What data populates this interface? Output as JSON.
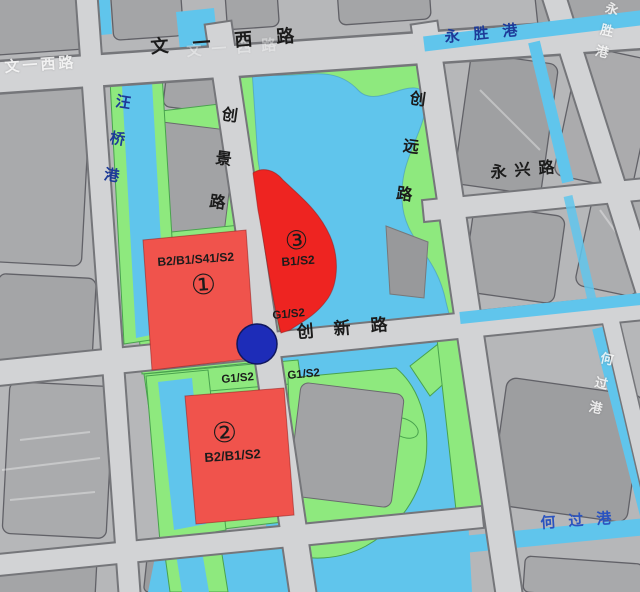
{
  "map": {
    "roads": {
      "wenyixi": "文一西路",
      "chuangjing": "创景路",
      "chuangyuan": "创远路",
      "chuangxin": "创新路",
      "yongxing": "永兴路"
    },
    "canals": {
      "wangqiao": "汪桥港",
      "yongsheng": "永胜港",
      "heguo": "何过港"
    },
    "ghost_labels": {
      "left_road": "文一西路",
      "top_right": "永胜港",
      "right_mid": "何过港"
    },
    "parcels": [
      {
        "id": "①",
        "code": "B2/B1/S41/S2"
      },
      {
        "id": "②",
        "code": "B2/B1/S2"
      },
      {
        "id": "③",
        "code": "B1/S2"
      }
    ],
    "zone_labels": {
      "a": "G1/S2",
      "b": "G1/S2",
      "c": "G1/S2"
    },
    "station_marker": "metro-station-dot",
    "colors": {
      "road_fill": "#d2d3d5",
      "road_casing": "#75767a",
      "block_gray": "#a4a5a7",
      "park_green": "#8ee97e",
      "water_blue": "#60c5ec",
      "parcel_red_light": "#f0534c",
      "parcel_red_bright": "#ee2421",
      "station_blue": "#1d2cb8",
      "canal_label_blue": "#1d3a98"
    }
  }
}
